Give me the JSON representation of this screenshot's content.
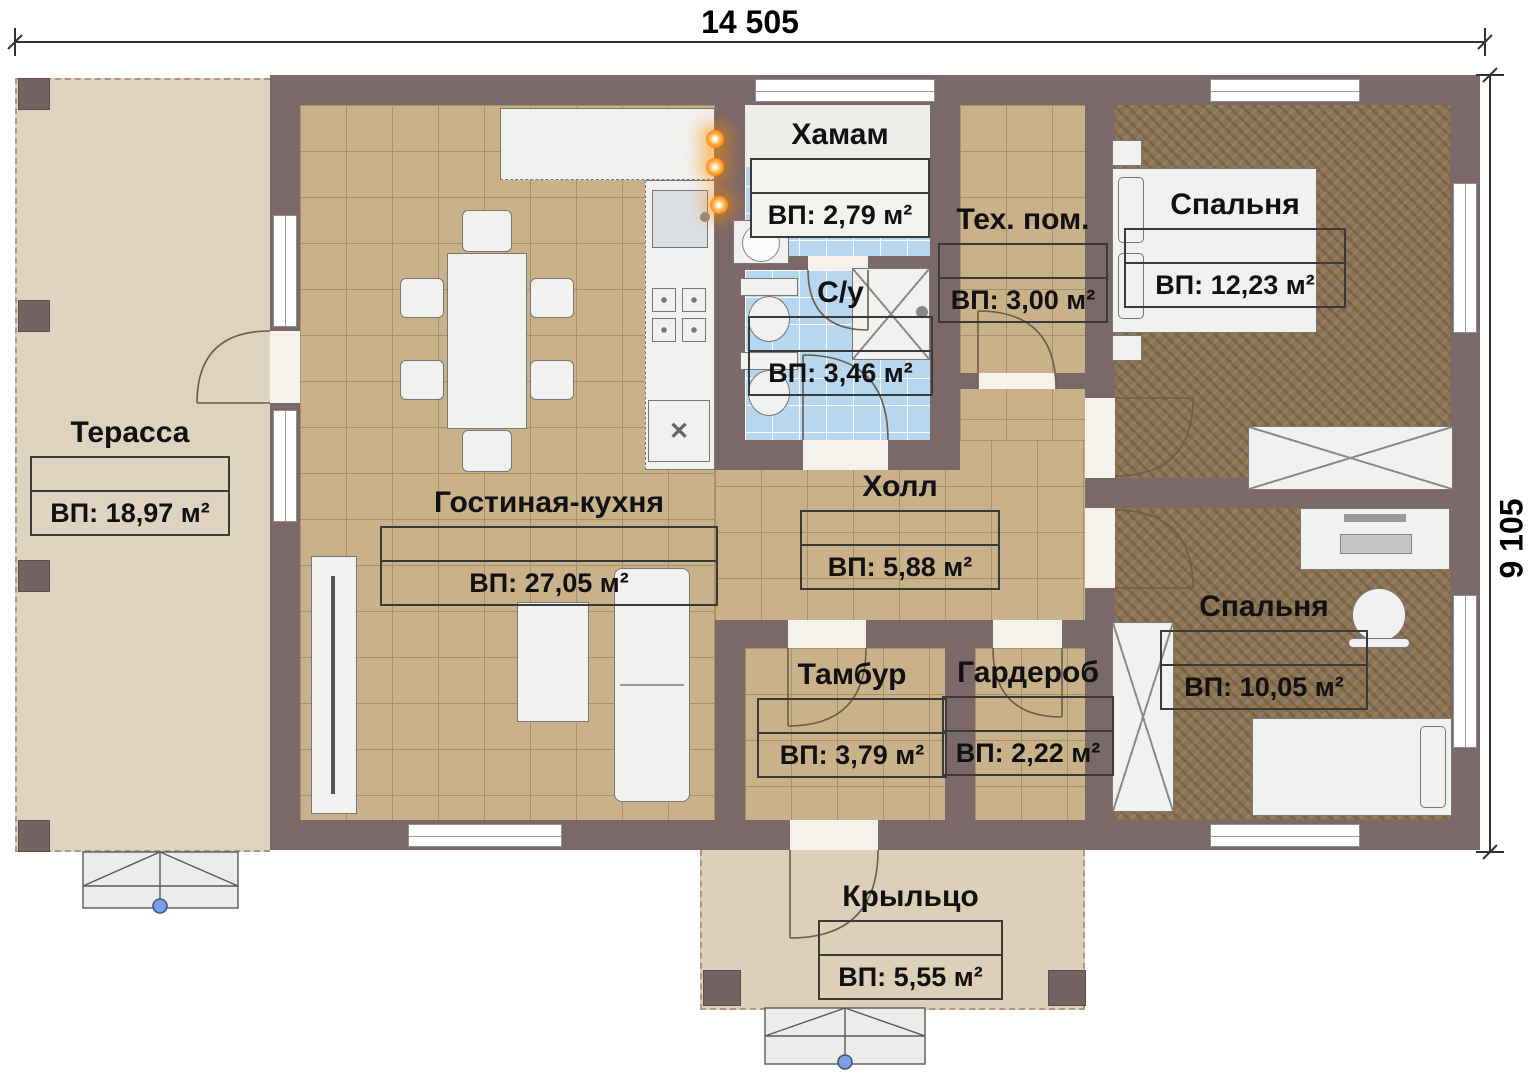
{
  "title": "floor-plan",
  "dimensions": {
    "top": "14 505",
    "right": "9 105"
  },
  "rooms": [
    {
      "id": "terrace",
      "name": "Терасса",
      "area": "ВП: 18,97 м²"
    },
    {
      "id": "living_kitchen",
      "name": "Гостиная-кухня",
      "area": "ВП: 27,05 м²"
    },
    {
      "id": "hamam",
      "name": "Хамам",
      "area": "ВП: 2,79 м²"
    },
    {
      "id": "bathroom",
      "name": "С/у",
      "area": "ВП: 3,46 м²"
    },
    {
      "id": "tech_room",
      "name": "Тех. пом.",
      "area": "ВП: 3,00 м²"
    },
    {
      "id": "bedroom_1",
      "name": "Спальня",
      "area": "ВП: 12,23 м²"
    },
    {
      "id": "hall",
      "name": "Холл",
      "area": "ВП: 5,88 м²"
    },
    {
      "id": "tambour",
      "name": "Тамбур",
      "area": "ВП: 3,79 м²"
    },
    {
      "id": "wardrobe",
      "name": "Гардероб",
      "area": "ВП: 2,22 м²"
    },
    {
      "id": "bedroom_2",
      "name": "Спальня",
      "area": "ВП: 10,05 м²"
    },
    {
      "id": "porch",
      "name": "Крыльцо",
      "area": "ВП: 5,55 м²"
    }
  ],
  "icons": {
    "cross": "✕"
  },
  "colors": {
    "wall": "#7b6868",
    "tile_floor": "#c9b189",
    "wood_floor": "#8c7351",
    "bath_tile": "#b7d6ef",
    "terrace_floor": "#ded3bf",
    "sconce_glow": "#ff7a00",
    "stair_marker": "#7aa0e0",
    "label_text": "#111111"
  }
}
